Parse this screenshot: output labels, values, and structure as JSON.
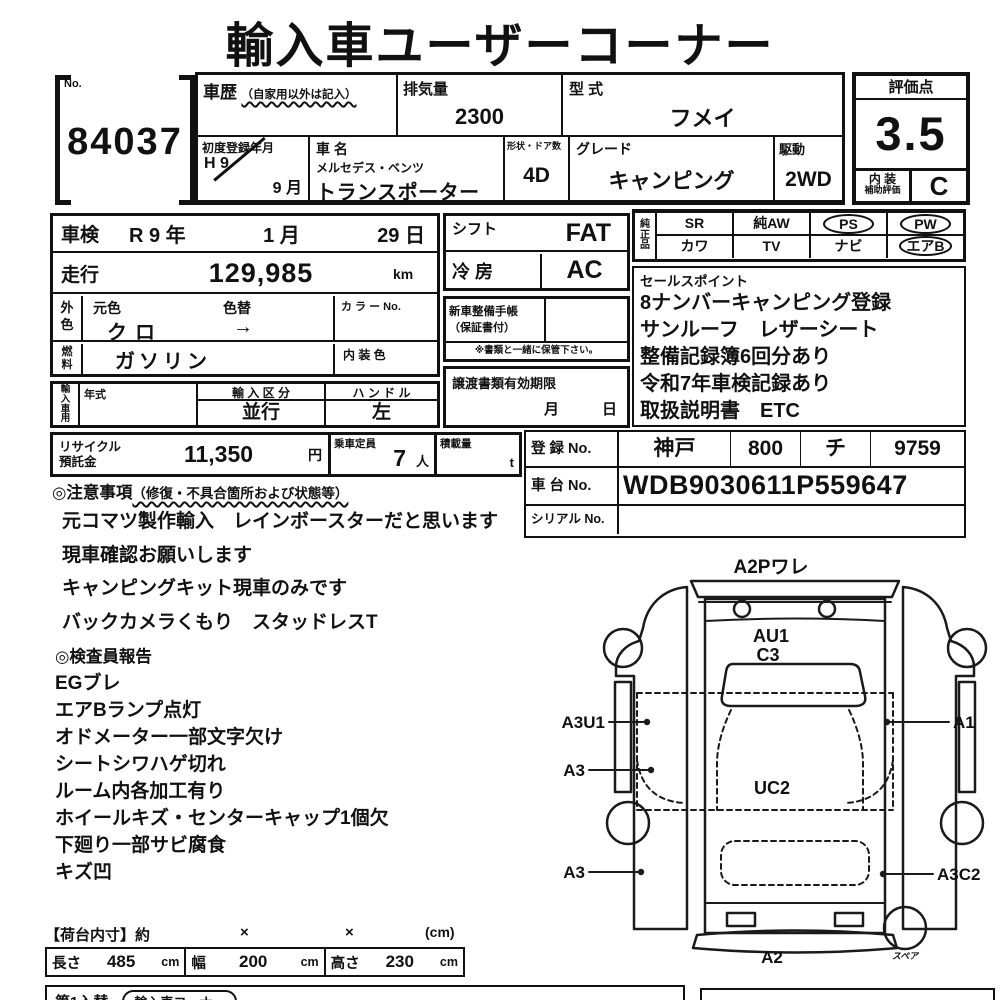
{
  "title": "輸入車ユーザーコーナー",
  "no_block": {
    "label": "No.",
    "value": "84037"
  },
  "vehicle": {
    "history_label": "車歴",
    "history_note": "（自家用以外は記入）",
    "displacement_label": "排気量",
    "displacement_value": "2300",
    "model_code_label": "型 式",
    "model_code_value": "フメイ",
    "first_reg_label": "初度登録年月",
    "first_reg_era": "H 9",
    "first_reg_month": "9 月",
    "name_label": "車 名",
    "maker": "メルセデス・ベンツ",
    "name_value": "トランスポーター",
    "body_doors_label": "形状・ドア数",
    "body_doors_value": "4D",
    "grade_label": "グレード",
    "grade_value": "キャンピング",
    "drive_label": "駆動",
    "drive_value": "2WD"
  },
  "score": {
    "header": "評価点",
    "value": "3.5",
    "interior_line1": "内 装",
    "interior_line2": "補助評価",
    "interior_grade": "C"
  },
  "details": {
    "shaken_label": "車検",
    "shaken_parts": [
      "R 9 年",
      "1 月",
      "29 日"
    ],
    "mileage_label": "走行",
    "mileage_value": "129,985",
    "mileage_unit": "km",
    "ext_color_label_1": "外",
    "ext_color_label_2": "色",
    "orig_color_label": "元色",
    "orig_color_value": "クロ",
    "color_change_label": "色替",
    "color_change_value": "→",
    "color_no_label": "カ ラ ー No.",
    "fuel_label_1": "燃",
    "fuel_label_2": "料",
    "fuel_value": "ガソリン",
    "interior_color_label": "内 装 色",
    "import_label": "輸入車用",
    "year_label": "年式",
    "import_class_label": "輸 入 区 分",
    "import_class_value": "並行",
    "handle_label": "ハ ン ド ル",
    "handle_value": "左"
  },
  "equipment": {
    "shift_label": "シフト",
    "shift_value": "FAT",
    "ac_label": "冷 房",
    "ac_value": "AC",
    "booklet_label_1": "新車整備手帳",
    "booklet_label_2": "（保証書付）",
    "booklet_note": "※書類と一緒に保管下さい。",
    "transfer_label": "譲渡書類有効期限",
    "transfer_month": "月",
    "transfer_day": "日"
  },
  "genuine": {
    "label": "純正品",
    "row1": [
      "SR",
      "純AW",
      "PS",
      "PW"
    ],
    "row2": [
      "カワ",
      "TV",
      "ナビ",
      "エアB"
    ],
    "circled": [
      "PS",
      "PW",
      "エアB"
    ]
  },
  "sales_points": {
    "header": "セールスポイント",
    "lines": [
      "8ナンバーキャンピング登録",
      "サンルーフ　レザーシート",
      "整備記録簿6回分あり",
      "令和7年車検記録あり",
      "取扱説明書　ETC"
    ]
  },
  "recycle": {
    "label_1": "リサイクル",
    "label_2": "預託金",
    "value": "11,350",
    "unit": "円",
    "capacity_label": "乗車定員",
    "capacity_value": "7",
    "capacity_unit": "人",
    "load_label": "積載量",
    "load_unit": "t"
  },
  "registration": {
    "reg_label": "登 録 No.",
    "reg_values": [
      "神戸",
      "800",
      "チ",
      "9759"
    ],
    "chassis_label": "車 台 No.",
    "chassis_value": "WDB9030611P559647",
    "serial_label": "シリアル No."
  },
  "cautions": {
    "header_main": "◎注意事項",
    "header_note": "（修復・不具合箇所および状態等）",
    "lines": [
      "元コマツ製作輸入　レインボースターだと思います",
      "現車確認お願いします",
      "キャンピングキット現車のみです",
      "バックカメラくもり　スタッドレスT"
    ]
  },
  "inspector": {
    "header": "◎検査員報告",
    "lines": [
      "EGブレ",
      "エアBランプ点灯",
      "オドメーター一部文字欠け",
      "シートシワハゲ切れ",
      "ルーム内各加工有り",
      "ホイールキズ・センターキャップ1個欠",
      "下廻り一部サビ腐食",
      "キズ凹"
    ]
  },
  "cargo": {
    "header": "【荷台内寸】約",
    "sep1": "×",
    "sep2": "×",
    "unit_note": "(cm)",
    "length_label": "長さ",
    "length_value": "485",
    "length_unit": "cm",
    "width_label": "幅",
    "width_value": "200",
    "width_unit": "cm",
    "height_label": "高さ",
    "height_value": "230",
    "height_unit": "cm"
  },
  "bottom": {
    "left_text": "第1入替",
    "capsule_text": "輸入車コーナー"
  },
  "diagram": {
    "labels": {
      "top": "A2Pワレ",
      "inner_top": "AU1",
      "inner_top2": "C3",
      "center": "UC2",
      "left_upper": "A3U1",
      "left_mid": "A3",
      "left_lower": "A3",
      "right_upper": "A1",
      "right_lower": "A3C2",
      "bottom": "A2",
      "spare": "スペア"
    }
  },
  "colors": {
    "ink": "#111111",
    "paper": "#ffffff"
  }
}
